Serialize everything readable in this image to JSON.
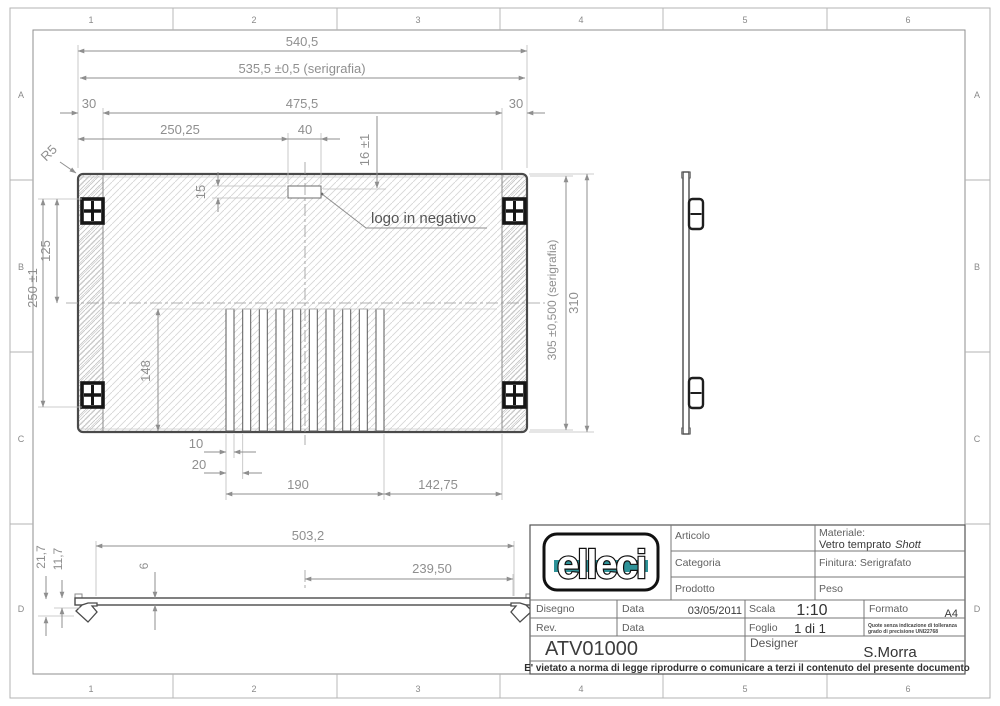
{
  "border": {
    "columns": [
      "1",
      "2",
      "3",
      "4",
      "5",
      "6"
    ],
    "rows": [
      "A",
      "B",
      "C",
      "D"
    ]
  },
  "front": {
    "total_width": "540,5",
    "serigraphy_width": "535,5 ±0,5 (serigrafia)",
    "left_margin": "30",
    "inner_width": "475,5",
    "right_margin": "30",
    "logo_center_offset": "250,25",
    "logo_width": "40",
    "logo_top_offset": "16 ±1",
    "logo_height": "15",
    "pad_half_span": "125",
    "pad_span": "250 ±1",
    "slot_height": "148",
    "serigraphy_height": "305 ±0,500 (serigrafia)",
    "total_height": "310",
    "slot_width": "10",
    "slot_pitch": "20",
    "slot_group_width": "190",
    "slot_to_edge": "142,75",
    "corner_radius": "R5",
    "logo_callout": "logo in negativo"
  },
  "profile": {
    "length": "503,2",
    "half_length": "239,50",
    "hook_height": "21,7",
    "hook_mid": "11,7",
    "thickness": "6"
  },
  "titleblock": {
    "logo": "elleci",
    "articolo": "Articolo",
    "categoria": "Categoria",
    "prodotto": "Prodotto",
    "materiale_label": "Materiale:",
    "materiale_value": "Vetro temprato",
    "materiale_value_em": "Shott",
    "finitura": "Finitura: Serigrafato",
    "peso": "Peso",
    "disegno": "Disegno",
    "data1": "Data",
    "data1_value": "03/05/2011",
    "scala": "Scala",
    "scala_value": "1:10",
    "formato": "Formato",
    "formato_value": "A4",
    "rev": "Rev.",
    "data2": "Data",
    "foglio": "Foglio",
    "foglio_value": "1 di 1",
    "note1": "Quote senza indicazione di tolleranza",
    "note2": "grado di precisione UNI22768",
    "code": "ATV01000",
    "designer": "Designer",
    "designer_value": "S.Morra",
    "footer": "E' vietato a norma di legge riprodurre o comunicare a terzi il contenuto del presente documento"
  }
}
